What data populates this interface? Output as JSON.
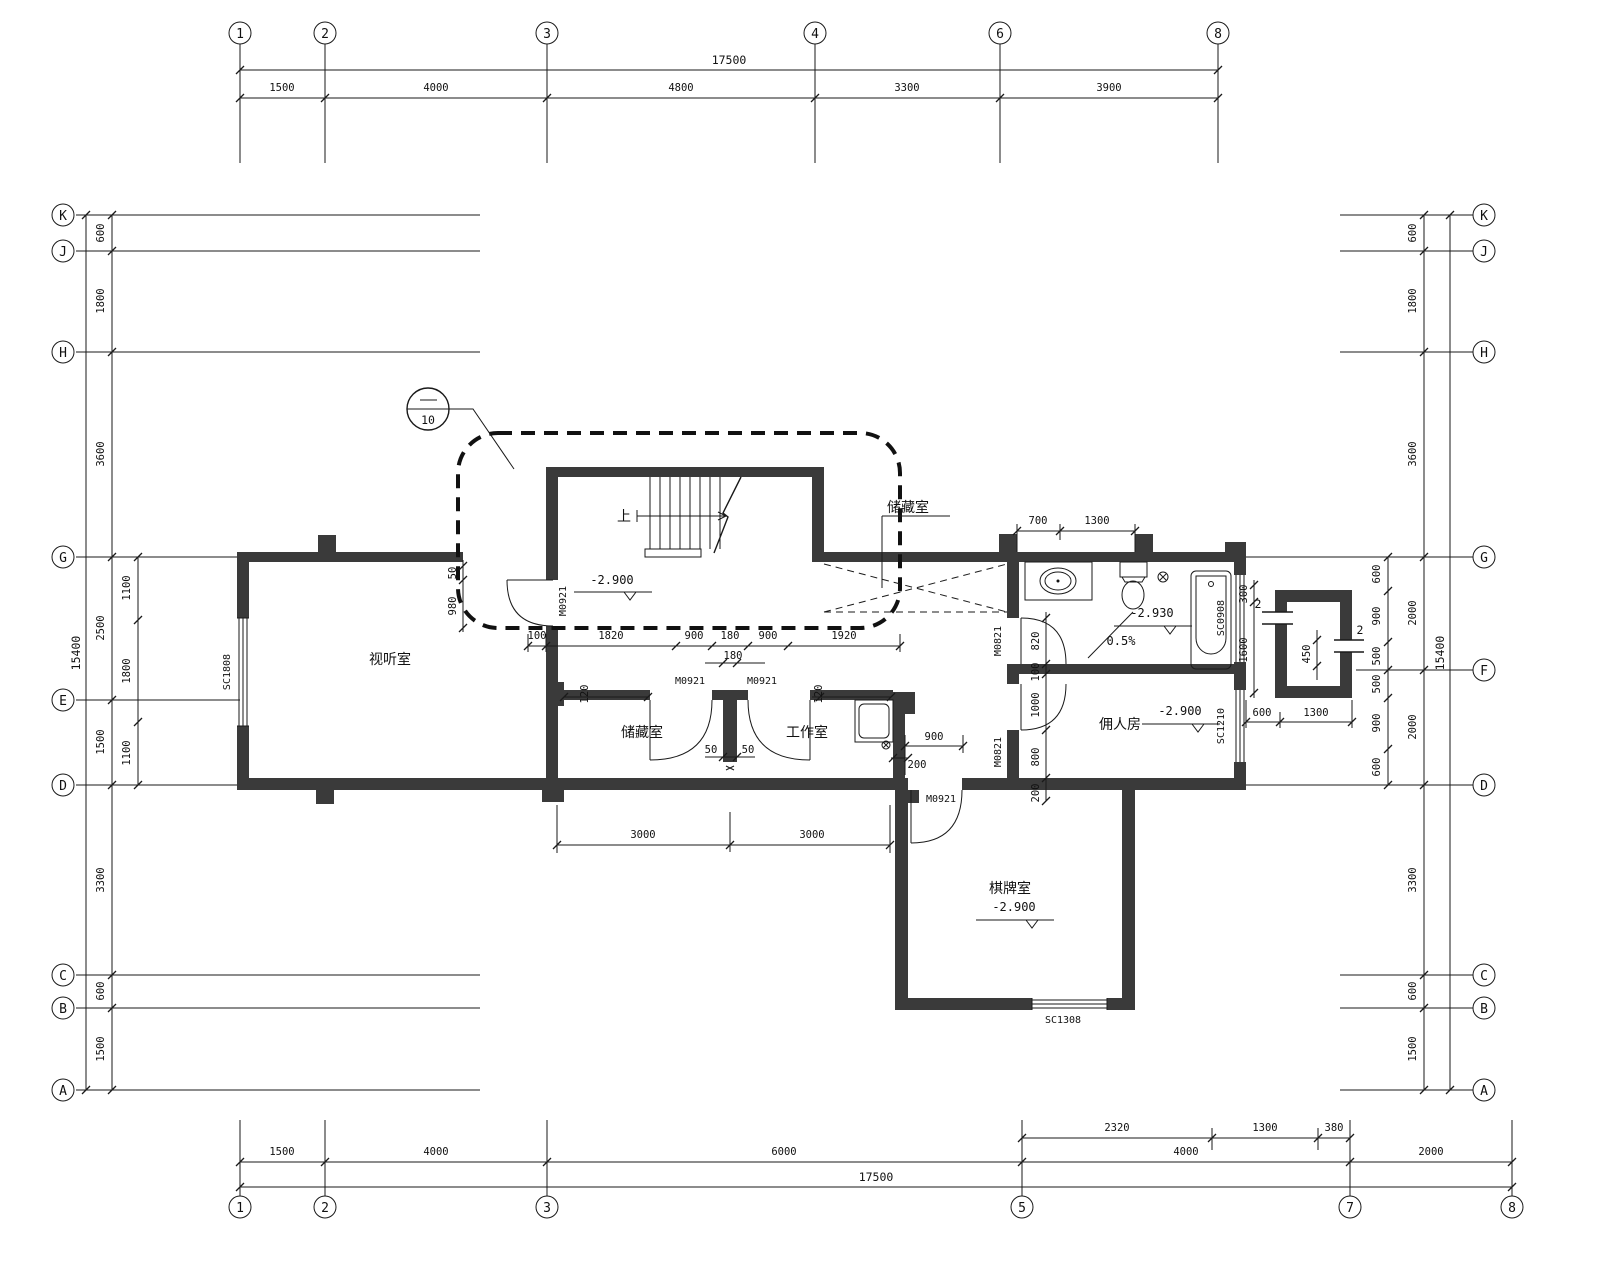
{
  "title": "地下层平面图 (basement floor plan)",
  "grid": {
    "top_bubbles": [
      "1",
      "2",
      "3",
      "4",
      "6",
      "8"
    ],
    "top_overall": "17500",
    "top_segments": [
      "1500",
      "4000",
      "4800",
      "3300",
      "3900"
    ],
    "bottom_bubbles": [
      "1",
      "2",
      "3",
      "5",
      "7",
      "8"
    ],
    "bottom_overall": "17500",
    "bottom_segments": [
      "1500",
      "4000",
      "6000",
      "4000",
      "2000"
    ],
    "bottom_sub": [
      "2320",
      "1300",
      "380"
    ],
    "left_bubbles": [
      "K",
      "J",
      "H",
      "G",
      "E",
      "D",
      "C",
      "B",
      "A"
    ],
    "left_overall": "15400",
    "left_segments": [
      "600",
      "1800",
      "3600",
      "2500",
      "1500",
      "3300",
      "600",
      "1500"
    ],
    "left_sub": [
      "1100",
      "1800",
      "1100"
    ],
    "right_bubbles": [
      "K",
      "J",
      "H",
      "G",
      "F",
      "D",
      "C",
      "B",
      "A"
    ],
    "right_overall": "15400",
    "right_segments": [
      "600",
      "1800",
      "3600",
      "2000",
      "2000",
      "3300",
      "600",
      "1500"
    ],
    "right_sub": [
      "600",
      "900",
      "500",
      "500",
      "900",
      "600"
    ]
  },
  "rooms": {
    "media": "视听室",
    "storage_under_stair": "储藏室",
    "storage": "储藏室",
    "work": "工作室",
    "servant": "佣人房",
    "chess": "棋牌室",
    "stair_up": "上"
  },
  "levels": {
    "hall": "-2.900",
    "bath": "-2.930",
    "bath_slope": "0.5%",
    "servant": "-2.900",
    "chess": "-2.900"
  },
  "openings": {
    "door_stair": "M0921",
    "door_storage": "M0921",
    "door_work": "M0921",
    "door_bath": "M0821",
    "door_servant": "M0821",
    "door_chess": "M0921",
    "window_media": "SC1808",
    "window_bath": "SC0908",
    "window_servant": "SC1210",
    "window_chess": "SC1308"
  },
  "dims": {
    "mid_chain": [
      "100",
      "1820",
      "900",
      "180",
      "900",
      "1920"
    ],
    "mid_sub": "180",
    "stair_side": [
      "50",
      "980"
    ],
    "bottom_mid": [
      "3000",
      "3000"
    ],
    "partition_offsets": [
      "120",
      "120"
    ],
    "stem": [
      "50",
      "50"
    ],
    "bath_top": [
      "700",
      "1300"
    ],
    "right_inner": [
      "820",
      "100",
      "1000",
      "800",
      "200"
    ],
    "chess_door": [
      "900",
      "200"
    ],
    "shaft_left": [
      "300",
      "1600"
    ],
    "shaft_inner": "450",
    "shaft_bottom": [
      "600",
      "1300"
    ],
    "section_mark": "2"
  },
  "detail": {
    "number": "10"
  }
}
